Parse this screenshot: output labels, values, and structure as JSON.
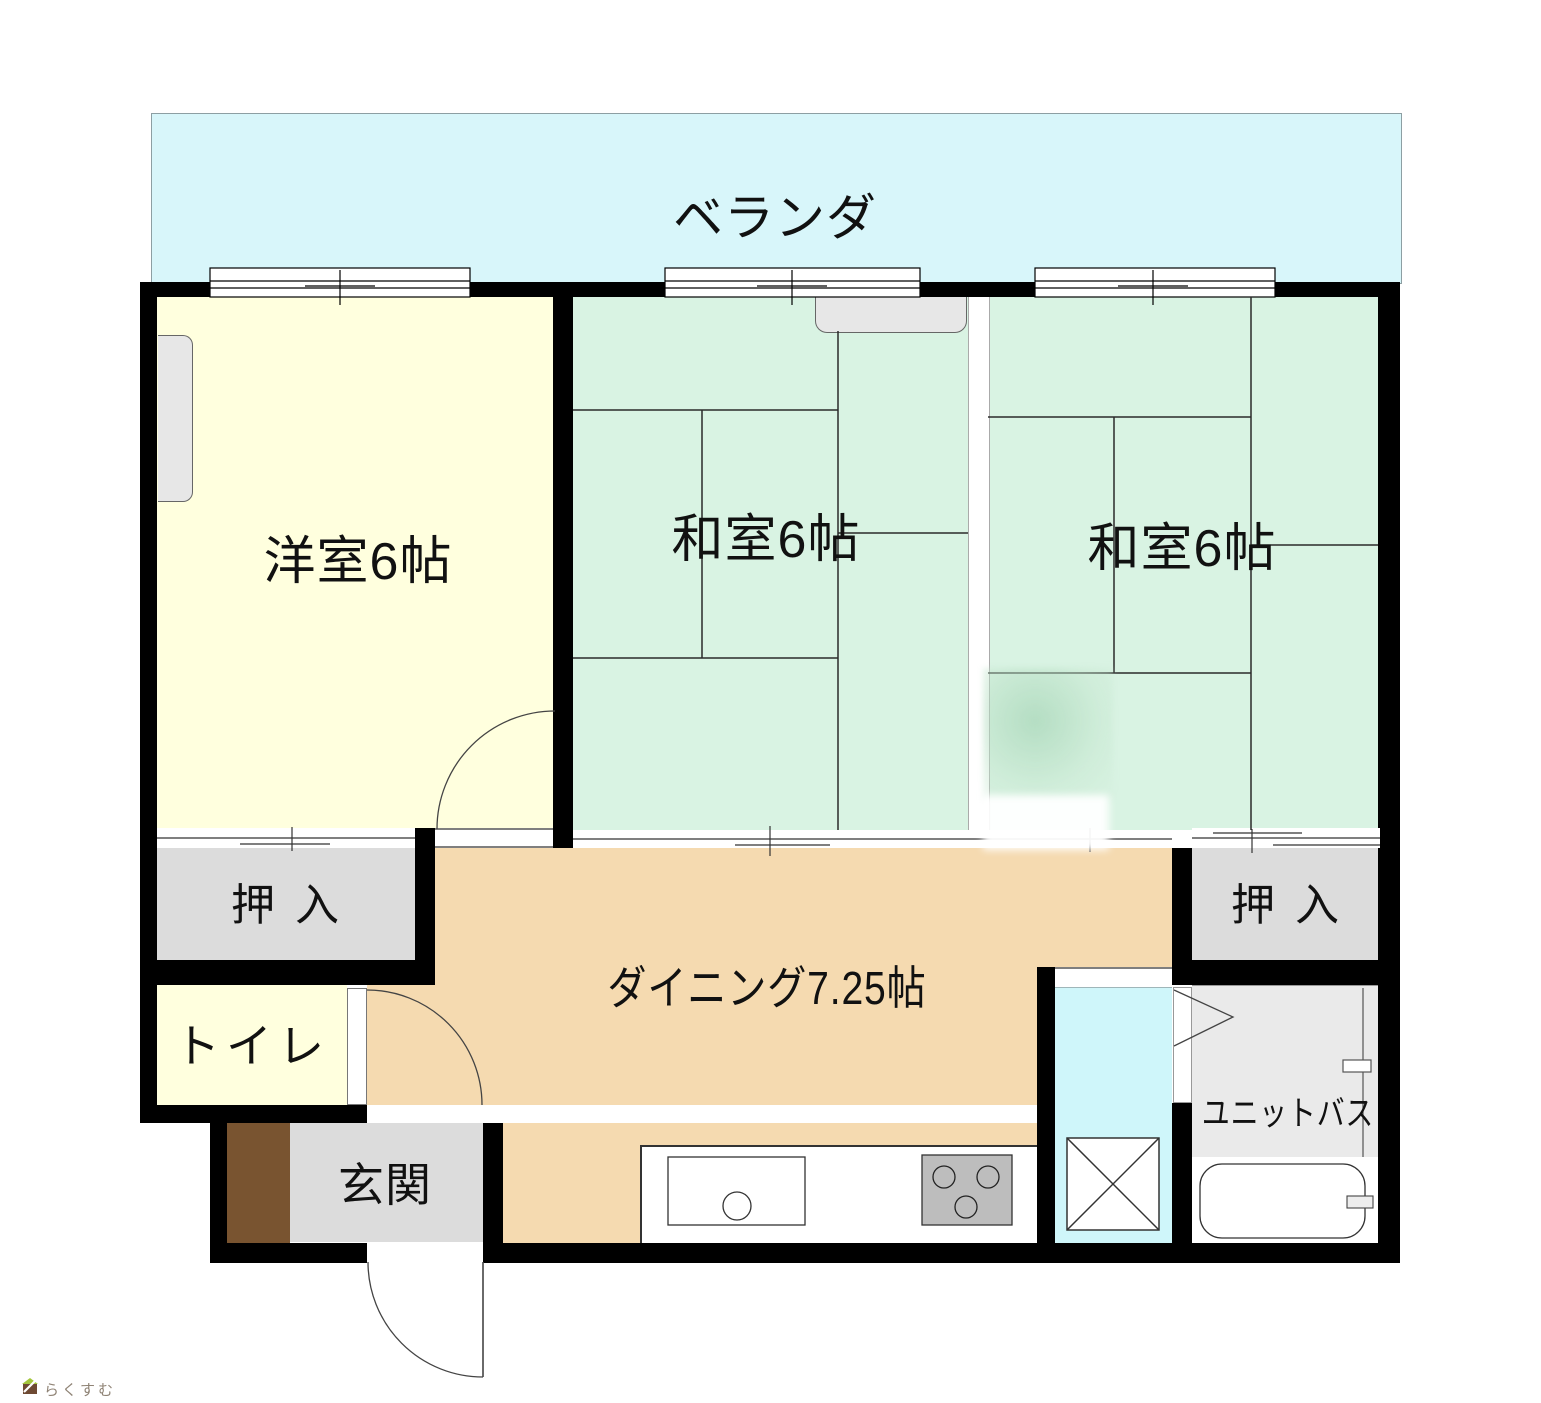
{
  "colors": {
    "veranda": "#D8F6FA",
    "tatami": "#D9F3E3",
    "western": "#FFFFDE",
    "dining": "#F5DAB0",
    "closet": "#DCDCDC",
    "bath": "#EAEAEA",
    "washing": "#CFF6FA",
    "wall": "#000000",
    "entrance_step_brown": "#795430",
    "stove": "#BDBDBD",
    "logo_green": "#A4C63C",
    "logo_brown": "#6E4A33",
    "logo_text": "#8F8375"
  },
  "rooms": {
    "veranda": {
      "label": "ベランダ"
    },
    "western": {
      "label": "洋室6帖"
    },
    "japanese_center": {
      "label": "和室6帖"
    },
    "japanese_right": {
      "label": "和室6帖"
    },
    "closet_left": {
      "label": "押入"
    },
    "closet_right": {
      "label": "押入"
    },
    "toilet": {
      "label": "トイレ"
    },
    "entrance": {
      "label": "玄関"
    },
    "dining": {
      "label": "ダイニング7.25帖"
    },
    "unit_bath": {
      "label": "ユニットバス"
    }
  },
  "branding": {
    "logo_text": "らくすむ"
  }
}
